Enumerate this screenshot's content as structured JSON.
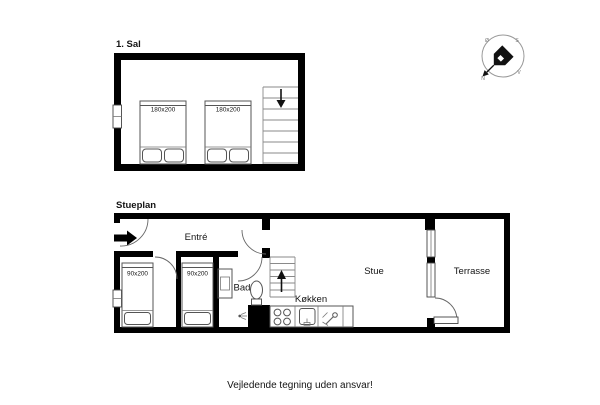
{
  "colors": {
    "wall": "#000000",
    "furniture_line": "#555555",
    "background": "#ffffff"
  },
  "floors": {
    "first": {
      "label": "1. Sal",
      "beds": [
        {
          "size": "180x200"
        },
        {
          "size": "180x200"
        }
      ]
    },
    "ground": {
      "label": "Stueplan",
      "rooms": {
        "entre": "Entré",
        "bad": "Bad",
        "kokken": "Køkken",
        "stue": "Stue",
        "terrasse": "Terrasse"
      },
      "beds": [
        {
          "size": "90x200"
        },
        {
          "size": "90x200"
        }
      ]
    }
  },
  "compass": {
    "n": "N",
    "s": "S",
    "east": "Ø",
    "west": "V"
  },
  "footer": {
    "disclaimer": "Vejledende tegning uden ansvar!"
  }
}
